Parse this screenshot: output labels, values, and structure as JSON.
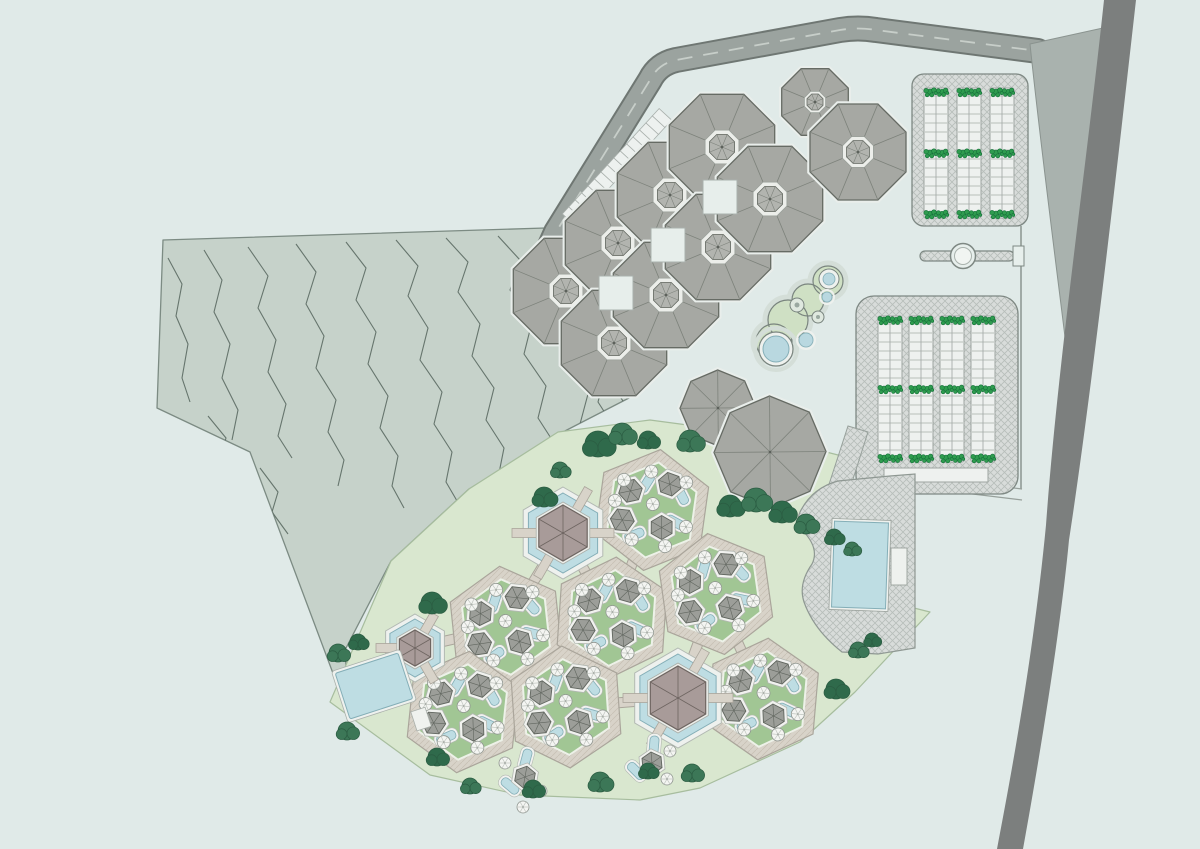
{
  "meta": {
    "title": ""
  },
  "palette": {
    "bg": "#e0eae8",
    "terrain": "#c6d2ca",
    "terrainEdge": "#7c8b83",
    "contour": "#5b6a63",
    "roadFill": "#9ba39f",
    "roadEdge": "#6f7773",
    "roadDash": "#c7cec9",
    "wedge": "#a9b2ae",
    "wedgeEdge": "#8a938f",
    "ribbon": "#7c7f7e",
    "octRoof": "#a6a8a3",
    "octEdge": "#666b64",
    "octLine": "#7d827b",
    "octBase": "#e9eeeb",
    "cupolaRim": "#eceeea",
    "cupola": "#b2b4af",
    "squareFill": "#e7eeeb",
    "squareEdge": "#a9b1ac",
    "parkBg": "#d8dcda",
    "hatchLine": "#b7beba",
    "parkEdge": "#7e8883",
    "stripBg": "#eef1ef",
    "rung": "#a6ada9",
    "shrub": "#2f9c4f",
    "shrubDark": "#15713a",
    "lawn": "#d9e7cf",
    "lawnEdge": "#a7bd9e",
    "courtGreen": "#a1c694",
    "courtGreenRim": "#edf1e8",
    "pave": "#d8d3c9",
    "paveLine": "#c5bfb2",
    "paveEdge": "#aaa59b",
    "poolBlue": "#bedde3",
    "poolEdge": "#84aeb7",
    "poolRim": "#eef2f0",
    "pavRoof": "#a89b99",
    "pavRoofEdge": "#6e6561",
    "hutRoof": "#9c9e99",
    "hutEdge": "#61665f",
    "hutRim": "#f1f2ef",
    "hutRimEdge": "#b2b7b1",
    "parasol": "#f4f5f2",
    "parasolEdge": "#8f958f",
    "spoke": "#c0c5bf",
    "tree": "#3c7757",
    "tree2": "#2f6a4b",
    "treeDark": "#2b5c42",
    "lagoonGreen": "#cfe0c4",
    "lagoonRing": "#79847e",
    "lagoonHalo": "#d4ded8",
    "gateFace": "#e7efec",
    "lineThin": "#97a09b"
  },
  "canvas": {
    "w": 1200,
    "h": 849
  },
  "terrain": {
    "outline": [
      [
        163,
        240
      ],
      [
        545,
        228
      ],
      [
        549,
        254
      ],
      [
        556,
        300
      ],
      [
        592,
        340
      ],
      [
        625,
        357
      ],
      [
        629,
        398
      ],
      [
        561,
        433
      ],
      [
        469,
        489
      ],
      [
        391,
        561
      ],
      [
        345,
        650
      ],
      [
        349,
        716
      ],
      [
        250,
        452
      ],
      [
        157,
        408
      ]
    ],
    "contours": [
      [
        [
          168,
          258
        ],
        [
          182,
          284
        ],
        [
          176,
          316
        ],
        [
          188,
          344
        ],
        [
          182,
          378
        ],
        [
          190,
          402
        ]
      ],
      [
        [
          204,
          250
        ],
        [
          222,
          280
        ],
        [
          214,
          312
        ],
        [
          230,
          344
        ],
        [
          222,
          378
        ],
        [
          238,
          410
        ],
        [
          232,
          440
        ]
      ],
      [
        [
          248,
          247
        ],
        [
          268,
          276
        ],
        [
          258,
          308
        ],
        [
          276,
          340
        ],
        [
          268,
          372
        ],
        [
          286,
          404
        ],
        [
          278,
          436
        ],
        [
          292,
          458
        ]
      ],
      [
        [
          296,
          244
        ],
        [
          316,
          272
        ],
        [
          306,
          304
        ],
        [
          324,
          336
        ],
        [
          316,
          368
        ],
        [
          336,
          400
        ],
        [
          328,
          432
        ],
        [
          344,
          460
        ],
        [
          338,
          486
        ]
      ],
      [
        [
          346,
          242
        ],
        [
          366,
          268
        ],
        [
          356,
          300
        ],
        [
          376,
          332
        ],
        [
          368,
          364
        ],
        [
          388,
          396
        ],
        [
          380,
          428
        ],
        [
          398,
          456
        ],
        [
          392,
          486
        ],
        [
          404,
          508
        ]
      ],
      [
        [
          396,
          240
        ],
        [
          418,
          266
        ],
        [
          408,
          296
        ],
        [
          428,
          328
        ],
        [
          420,
          360
        ],
        [
          442,
          392
        ],
        [
          434,
          424
        ],
        [
          452,
          452
        ],
        [
          446,
          482
        ],
        [
          460,
          506
        ],
        [
          456,
          526
        ]
      ],
      [
        [
          446,
          238
        ],
        [
          468,
          262
        ],
        [
          458,
          292
        ],
        [
          480,
          324
        ],
        [
          472,
          356
        ],
        [
          494,
          388
        ],
        [
          486,
          420
        ],
        [
          504,
          448
        ],
        [
          498,
          478
        ],
        [
          512,
          502
        ],
        [
          508,
          524
        ],
        [
          518,
          542
        ]
      ],
      [
        [
          498,
          236
        ],
        [
          520,
          260
        ],
        [
          510,
          290
        ],
        [
          532,
          322
        ],
        [
          524,
          354
        ],
        [
          546,
          386
        ],
        [
          538,
          418
        ],
        [
          556,
          446
        ],
        [
          550,
          476
        ],
        [
          564,
          500
        ],
        [
          558,
          524
        ],
        [
          570,
          544
        ],
        [
          566,
          562
        ]
      ],
      [
        [
          542,
          244
        ],
        [
          562,
          270
        ],
        [
          554,
          298
        ],
        [
          576,
          330
        ],
        [
          568,
          362
        ],
        [
          588,
          394
        ],
        [
          580,
          424
        ],
        [
          598,
          452
        ],
        [
          592,
          480
        ],
        [
          606,
          504
        ]
      ],
      [
        [
          574,
          288
        ],
        [
          594,
          314
        ],
        [
          586,
          342
        ],
        [
          606,
          372
        ],
        [
          598,
          402
        ],
        [
          616,
          430
        ],
        [
          610,
          458
        ],
        [
          624,
          480
        ]
      ],
      [
        [
          602,
          330
        ],
        [
          620,
          356
        ],
        [
          612,
          384
        ],
        [
          630,
          412
        ],
        [
          622,
          440
        ],
        [
          636,
          462
        ]
      ],
      [
        [
          624,
          372
        ],
        [
          640,
          396
        ],
        [
          632,
          424
        ],
        [
          646,
          448
        ]
      ],
      [
        [
          208,
          416
        ],
        [
          226,
          438
        ],
        [
          220,
          458
        ],
        [
          236,
          478
        ]
      ],
      [
        [
          260,
          468
        ],
        [
          278,
          492
        ],
        [
          272,
          512
        ],
        [
          288,
          534
        ]
      ]
    ]
  },
  "road": {
    "path": "M548,250 L556,232 L650,80 Q658,64 676,60 L840,30 Q858,27 876,30 L1038,51",
    "width": 22,
    "casing": 26,
    "dash": "15 11"
  },
  "stalls": {
    "from": [
      572,
      216
    ],
    "to": [
      662,
      118
    ],
    "count": 15,
    "w": 10,
    "len": 17
  },
  "wedge": {
    "path": "M1030,44 L1112,26 C1102,130 1082,250 1066,345 C1054,248 1040,140 1030,44 Z"
  },
  "ribbon": {
    "path": "M1104,0 C1086,170 1058,360 1046,525 C1034,650 1013,765 997,849 L1023,849 C1041,750 1061,625 1069,540 C1092,390 1118,160 1136,0 Z"
  },
  "gate": {
    "bar": [
      920,
      251,
      94,
      10
    ],
    "circle": [
      963,
      256,
      12.5,
      8.5
    ],
    "bracket": [
      1013,
      246,
      11,
      20
    ],
    "vlines": [
      [
        1021,
        226,
        1021,
        249
      ],
      [
        1021,
        265,
        1021,
        489
      ]
    ],
    "walkway": [
      [
        915,
        476,
        1022,
        489
      ],
      [
        915,
        487,
        1022,
        500
      ]
    ]
  },
  "parking": [
    {
      "rect": [
        912,
        74,
        116,
        152,
        12
      ],
      "strips": {
        "xs": [
          936,
          969,
          1002
        ],
        "y": 88,
        "h": 130,
        "w": 24,
        "rung": 9
      },
      "shrubRows": [
        92,
        153,
        214
      ]
    },
    {
      "rect": [
        856,
        296,
        162,
        198,
        18
      ],
      "strips": {
        "xs": [
          890,
          921,
          952,
          983
        ],
        "y": 316,
        "h": 146,
        "w": 24,
        "rung": 9
      },
      "shrubRows": [
        320,
        389,
        458
      ],
      "dropoff": [
        884,
        468,
        104,
        14
      ]
    }
  ],
  "accessBand": [
    [
      848,
      426
    ],
    [
      868,
      432
    ],
    [
      840,
      520
    ],
    [
      820,
      512
    ]
  ],
  "lagoon": {
    "blobs": [
      [
        788,
        320,
        20
      ],
      [
        808,
        300,
        16
      ],
      [
        828,
        281,
        15
      ],
      [
        774,
        342,
        18
      ]
    ],
    "poolBig": [
      776,
      349,
      17,
      13
    ],
    "ringPool": [
      829,
      279,
      10,
      6
    ],
    "dotRings": [
      [
        797,
        305,
        7,
        2.5
      ],
      [
        818,
        317,
        6,
        2
      ]
    ],
    "blues": [
      [
        806,
        340,
        7
      ],
      [
        827,
        297,
        5
      ]
    ]
  },
  "octagons": {
    "cluster": [
      [
        566,
        291
      ],
      [
        618,
        243
      ],
      [
        670,
        195
      ],
      [
        722,
        147
      ],
      [
        614,
        343
      ],
      [
        666,
        295
      ],
      [
        718,
        247
      ],
      [
        770,
        199
      ]
    ],
    "clusterR": 57,
    "squares": [
      [
        616,
        293
      ],
      [
        668,
        245
      ],
      [
        720,
        197
      ]
    ],
    "squareSide": 34,
    "pairNE": [
      [
        815,
        102,
        36
      ],
      [
        858,
        152,
        52
      ]
    ],
    "pairC": [
      [
        718,
        408,
        38
      ],
      [
        770,
        452,
        56
      ]
    ],
    "pairCRot": 22
  },
  "resort": {
    "outline": [
      [
        558,
        432
      ],
      [
        650,
        420
      ],
      [
        755,
        434
      ],
      [
        842,
        456
      ],
      [
        872,
        522
      ],
      [
        882,
        600
      ],
      [
        930,
        612
      ],
      [
        855,
        692
      ],
      [
        800,
        742
      ],
      [
        700,
        788
      ],
      [
        640,
        800
      ],
      [
        520,
        795
      ],
      [
        430,
        775
      ],
      [
        330,
        702
      ],
      [
        391,
        561
      ],
      [
        469,
        489
      ]
    ],
    "connectors": [
      [
        563,
        533,
        652,
        510
      ],
      [
        563,
        533,
        612,
        618
      ],
      [
        563,
        533,
        506,
        627
      ],
      [
        652,
        510,
        612,
        618
      ],
      [
        652,
        510,
        716,
        594
      ],
      [
        612,
        618,
        716,
        594
      ],
      [
        612,
        618,
        506,
        627
      ],
      [
        612,
        618,
        566,
        707
      ],
      [
        506,
        627,
        463,
        712
      ],
      [
        506,
        627,
        415,
        648
      ],
      [
        463,
        712,
        415,
        648
      ],
      [
        463,
        712,
        566,
        707
      ],
      [
        566,
        707,
        678,
        698
      ],
      [
        716,
        594,
        678,
        698
      ],
      [
        716,
        594,
        763,
        699
      ],
      [
        763,
        699,
        678,
        698
      ]
    ],
    "courts": [
      [
        652,
        510,
        8
      ],
      [
        506,
        627,
        -6
      ],
      [
        612,
        618,
        4
      ],
      [
        716,
        594,
        -8
      ],
      [
        463,
        712,
        6
      ],
      [
        566,
        707,
        -4
      ],
      [
        763,
        699,
        5
      ]
    ],
    "courtOuterR": 61,
    "courtInnerR": 48,
    "template": {
      "huts": [
        {
          "dx": -24,
          "dy": -16,
          "rot": 10
        },
        {
          "dx": 14,
          "dy": -28,
          "rot": -18
        },
        {
          "dx": -28,
          "dy": 14,
          "rot": 28
        },
        {
          "dx": 12,
          "dy": 16,
          "rot": -8
        }
      ],
      "hutR": 12,
      "pools": [
        {
          "dx": -9,
          "dy": -26,
          "rot": 24
        },
        {
          "dx": 27,
          "dy": -19,
          "rot": -35
        },
        {
          "dx": -14,
          "dy": 27,
          "rot": 60
        },
        {
          "dx": 25,
          "dy": 9,
          "rot": -70
        }
      ],
      "parasols": [
        [
          -38,
          -4
        ],
        [
          -6,
          -38
        ],
        [
          30,
          -32
        ],
        [
          36,
          12
        ],
        [
          -16,
          32
        ],
        [
          18,
          34
        ],
        [
          0,
          -6
        ],
        [
          -32,
          -26
        ]
      ]
    },
    "pavilions": [
      {
        "cx": 563,
        "cy": 533,
        "rim": 46,
        "pool": 40,
        "roofRim": 31,
        "roof": 28,
        "bridges": [
          0,
          1,
          3,
          4
        ]
      },
      {
        "cx": 415,
        "cy": 648,
        "rim": 34,
        "pool": 29,
        "roofRim": 21,
        "roof": 18,
        "bridges": [
          0,
          2,
          4
        ]
      },
      {
        "cx": 678,
        "cy": 698,
        "rim": 50,
        "pool": 44,
        "roofRim": 35,
        "roof": 32,
        "bridges": [
          0,
          1,
          3,
          4
        ]
      }
    ],
    "standalone": [
      {
        "cx": 525,
        "cy": 777,
        "r": 11,
        "rot": 10,
        "pools": [
          [
            1,
            -18,
            15
          ],
          [
            -15,
            9,
            -50
          ]
        ],
        "parasols": [
          [
            16,
            14
          ],
          [
            -2,
            30
          ],
          [
            -20,
            -14
          ]
        ]
      },
      {
        "cx": 652,
        "cy": 763,
        "r": 11,
        "rot": -5,
        "pools": [
          [
            2,
            -17,
            5
          ],
          [
            -16,
            8,
            -45
          ]
        ],
        "parasols": [
          [
            18,
            -12
          ],
          [
            15,
            16
          ]
        ]
      }
    ],
    "poolLeft": {
      "cx": 374,
      "cy": 686,
      "w": 66,
      "h": 48,
      "rot": -18,
      "pad": [
        401,
        722,
        15,
        20
      ]
    }
  },
  "deck": {
    "path": "M800,512 Q812,488 838,481 L890,476 L915,474 L915,648 L878,654 L842,652 Q814,630 804,602 Q798,584 812,564 Q820,548 802,530 Q796,520 800,512 Z",
    "pool": {
      "cx": 860,
      "cy": 565,
      "w": 54,
      "h": 86,
      "rot": 2
    },
    "pad": [
      891,
      548,
      16,
      37
    ]
  },
  "trees": [
    [
      598,
      444,
      13
    ],
    [
      622,
      434,
      11
    ],
    [
      648,
      440,
      9
    ],
    [
      690,
      441,
      11
    ],
    [
      730,
      506,
      11
    ],
    [
      756,
      500,
      12
    ],
    [
      782,
      512,
      11
    ],
    [
      806,
      524,
      10
    ],
    [
      834,
      537,
      8
    ],
    [
      852,
      549,
      7
    ],
    [
      544,
      497,
      10
    ],
    [
      560,
      470,
      8
    ],
    [
      432,
      603,
      11
    ],
    [
      338,
      653,
      9
    ],
    [
      358,
      642,
      8
    ],
    [
      347,
      731,
      9
    ],
    [
      437,
      757,
      9
    ],
    [
      470,
      786,
      8
    ],
    [
      533,
      789,
      9
    ],
    [
      600,
      782,
      10
    ],
    [
      648,
      771,
      8
    ],
    [
      692,
      773,
      9
    ],
    [
      836,
      689,
      10
    ],
    [
      858,
      650,
      8
    ],
    [
      872,
      640,
      7
    ]
  ]
}
